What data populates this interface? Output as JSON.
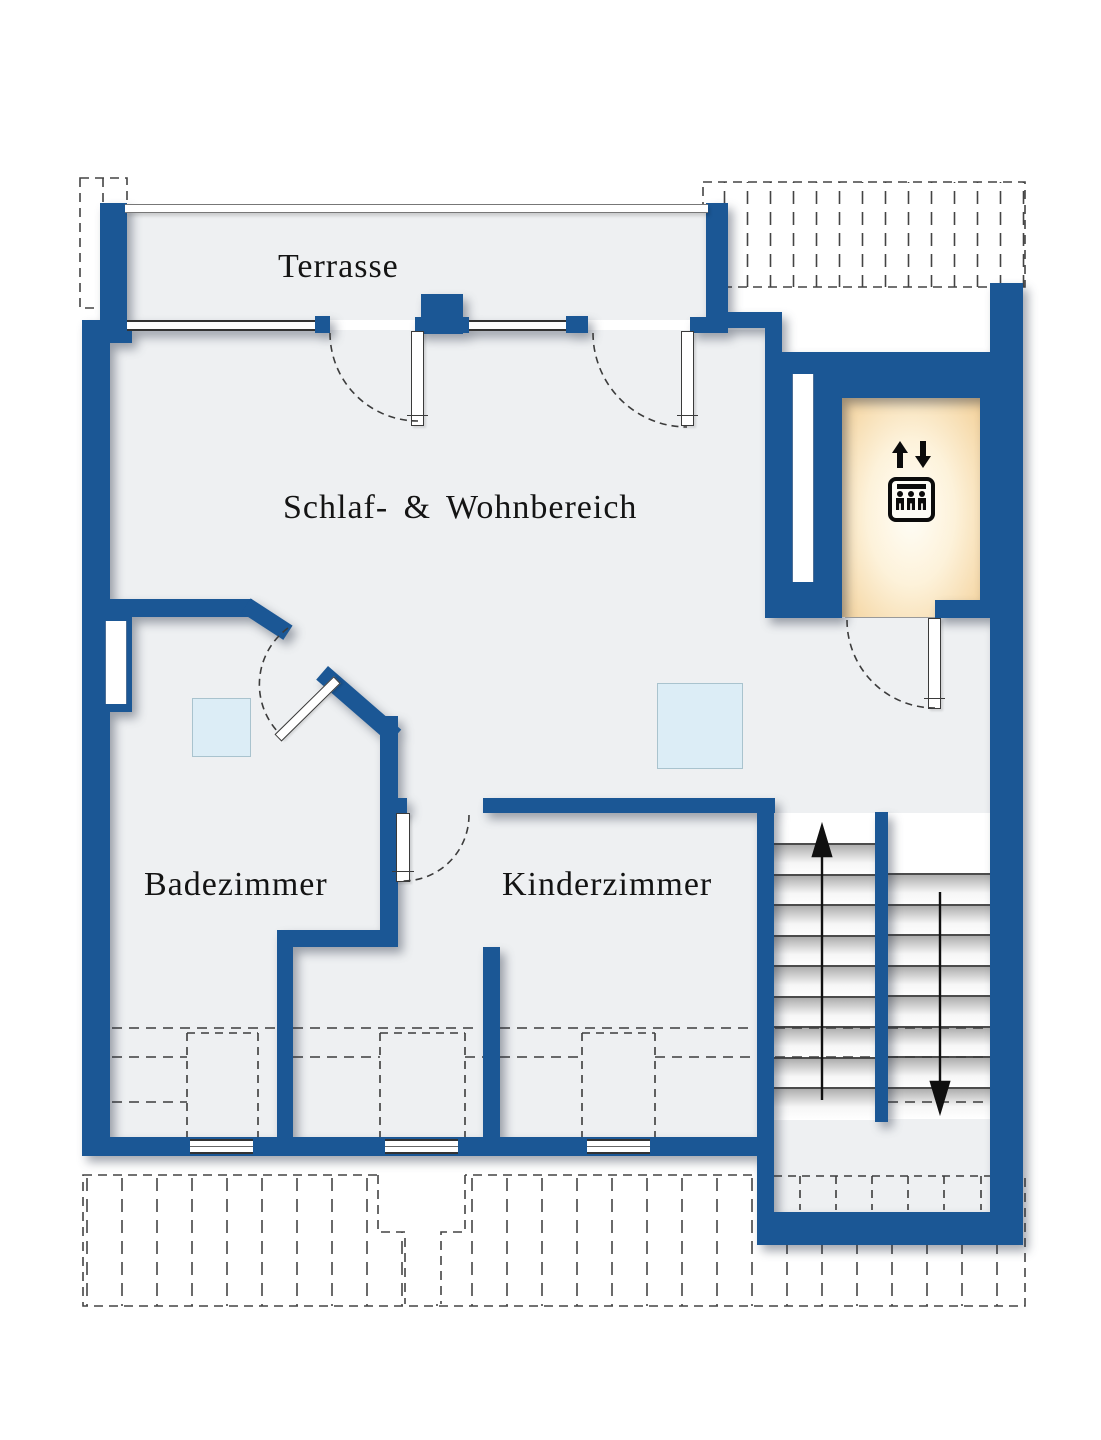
{
  "plan": {
    "title": "Dachgeschoss Grundriss",
    "rooms": [
      {
        "id": "terrace",
        "label": "Terrasse"
      },
      {
        "id": "living",
        "label": "Schlaf- & Wohnbereich"
      },
      {
        "id": "bathroom",
        "label": "Badezimmer"
      },
      {
        "id": "kids",
        "label": "Kinderzimmer"
      }
    ],
    "stairs": {
      "up_arrow": "up",
      "down_arrow": "down"
    },
    "elevator": {
      "icon": "elevator-icon",
      "persons": 3,
      "arrows": "up-down"
    },
    "colors": {
      "wall": "#1b5795",
      "floor": "#eef0f2",
      "skylight": "#dcedf6",
      "cabin_glow_edge": "#f3d098",
      "cabin_glow_center": "#fffef8",
      "dash": "#3c3c3c",
      "ink": "#141414"
    }
  }
}
